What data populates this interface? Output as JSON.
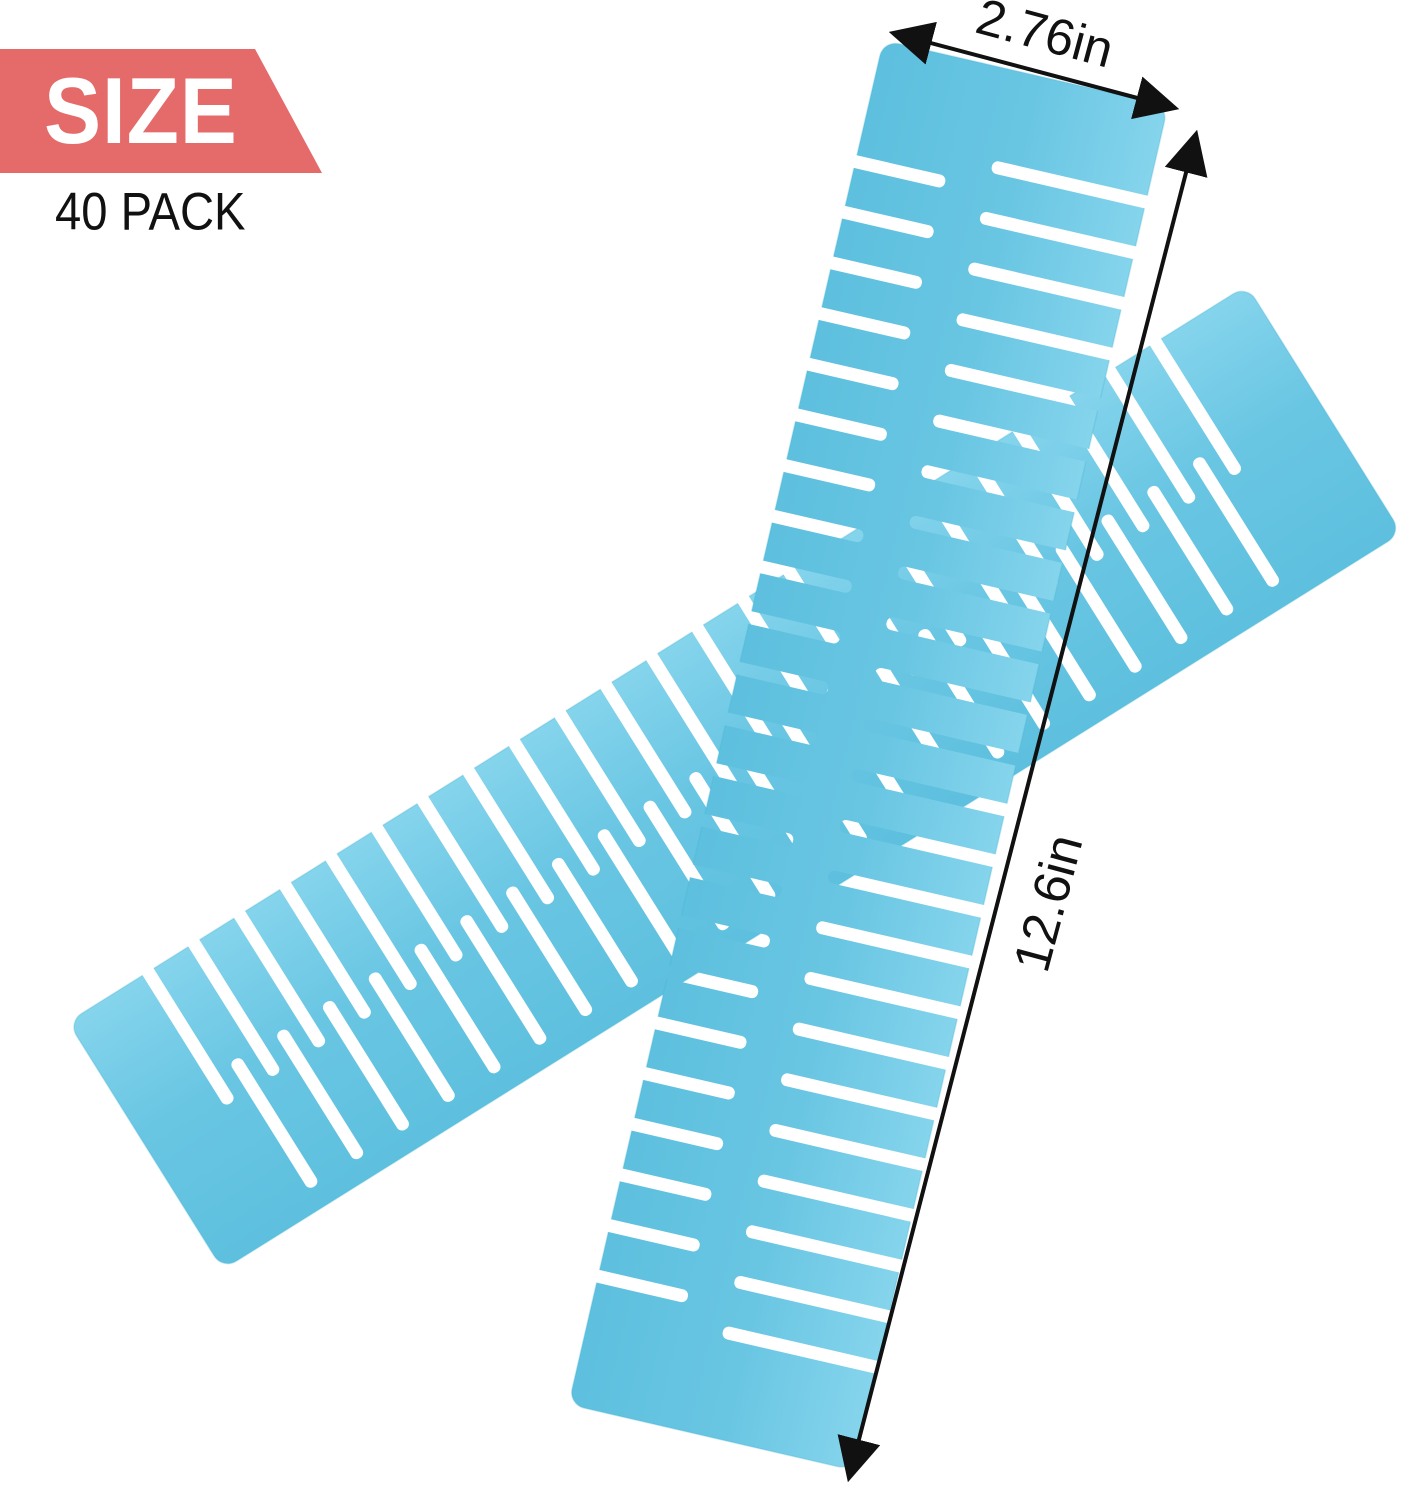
{
  "page": {
    "background_color": "#ffffff"
  },
  "badge": {
    "label": "SIZE",
    "bg_color": "#e56a6a",
    "text_color": "#ffffff"
  },
  "pack": {
    "label": "40 PACK",
    "text_color": "#111111"
  },
  "dimensions": {
    "width_label": "2.76in",
    "length_label": "12.6in",
    "line_color": "#111111",
    "text_color": "#111111"
  },
  "product": {
    "item": "drawer-divider-strip",
    "strip_count": 2,
    "color": "#69c6e3",
    "color_light": "#85d4ec",
    "color_dark": "#5dc0de",
    "edge_color": "#49b3d4"
  }
}
